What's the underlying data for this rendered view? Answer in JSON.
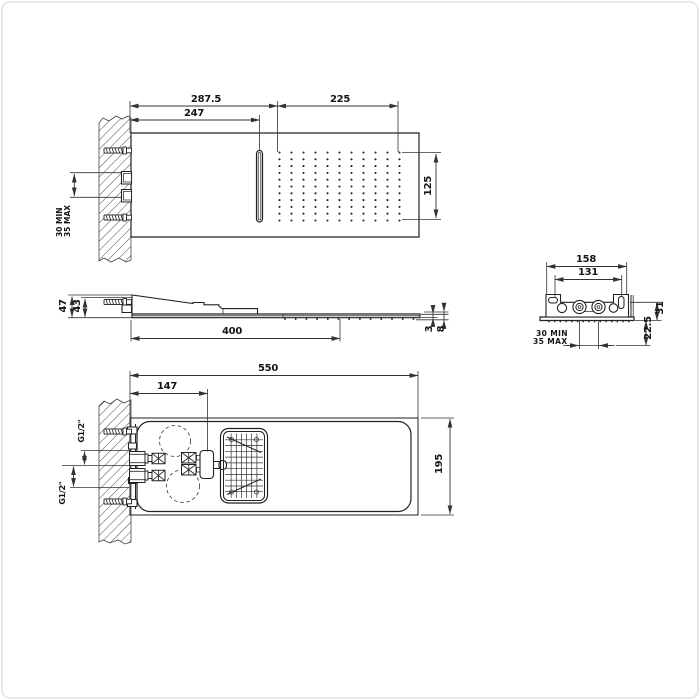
{
  "drawing": {
    "front_view": {
      "dim_total_to_spray": "287.5",
      "dim_to_slot": "247",
      "dim_spray_width": "225",
      "dim_spray_height": "125",
      "wall_depth": {
        "line1": "30 MIN",
        "line2": "35 MAX"
      }
    },
    "side_view": {
      "dim_height_total": "47",
      "dim_height_body": "43",
      "dim_length": "400",
      "dim_plate_thickness": "3",
      "dim_edge_thickness": "8"
    },
    "section_view": {
      "dim_width_outer": "158",
      "dim_width_inner": "131",
      "dim_height": "31",
      "dim_depth": "22.5",
      "wall_depth": {
        "line1": "30 MIN",
        "line2": "35 MAX"
      }
    },
    "plan_view": {
      "dim_length": "550",
      "dim_inlet_offset": "147",
      "dim_width": "195",
      "thread_label_top": "G1/2\"",
      "thread_label_bottom": "G1/2\""
    }
  }
}
